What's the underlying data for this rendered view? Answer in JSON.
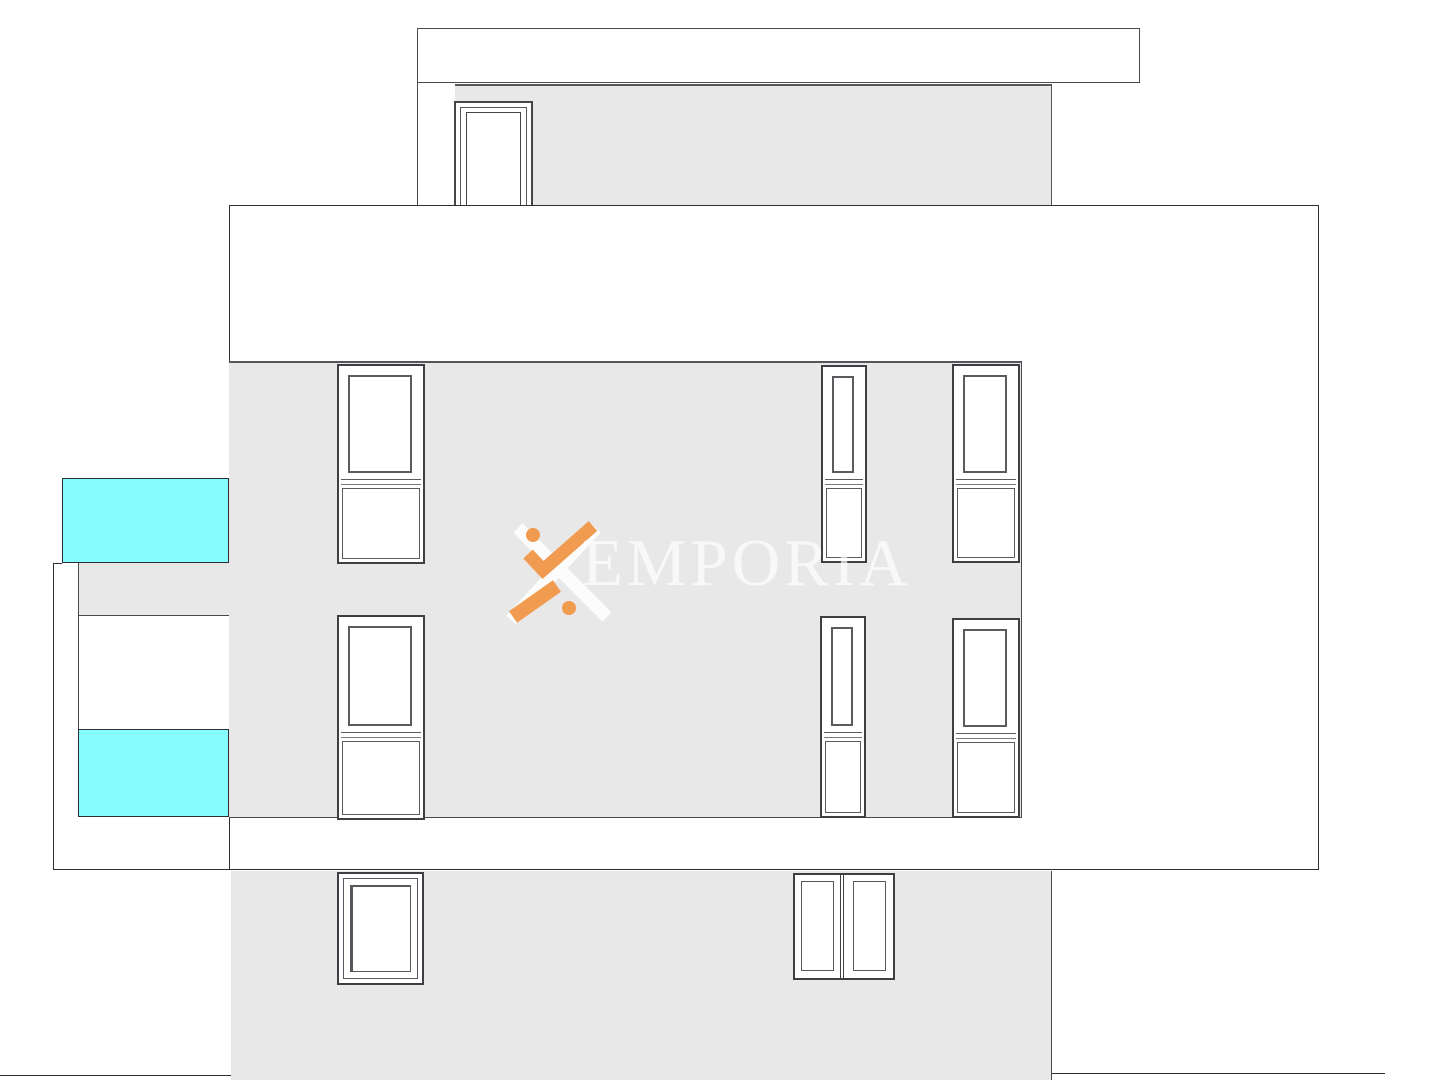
{
  "drawing": {
    "type": "building-elevation",
    "floors": [
      "roof-terrace",
      "upper-floor",
      "main-floor",
      "ground-floor"
    ],
    "window_count": 9,
    "pool_panel_count": 2
  },
  "watermark": {
    "brand_text": "EMPORIA",
    "logo": "x-mark-with-dots"
  },
  "colors": {
    "background": "#ffffff",
    "wall_fill": "#e8e8e8",
    "pool_fill": "#85fdfe",
    "outline_dark": "#2e2e32",
    "frame_line": "#55585c",
    "logo_orange": "#f09b50",
    "logo_white": "rgba(255,255,255,0.85)",
    "watermark_text_color": "rgba(255,255,255,0.68)"
  }
}
